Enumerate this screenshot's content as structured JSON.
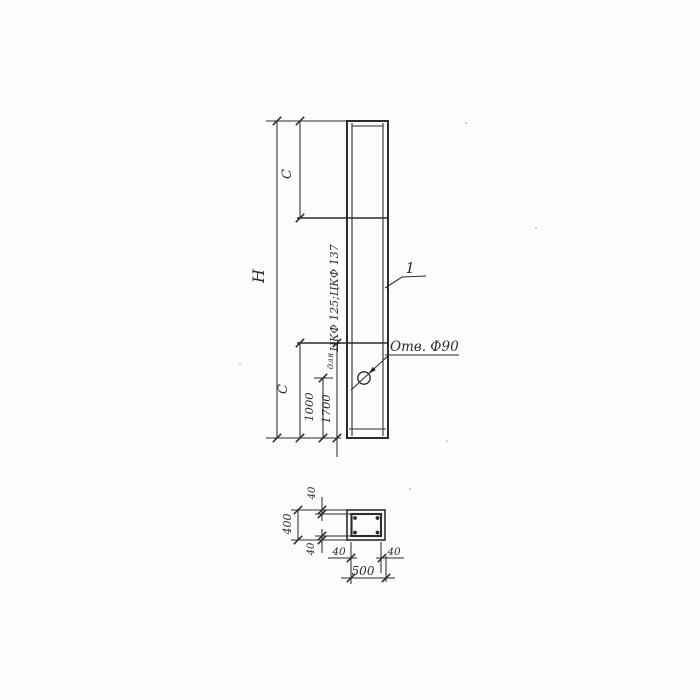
{
  "drawing": {
    "type": "engineering-drawing",
    "views": {
      "elevation": {
        "dim_total_height_label": "H",
        "dim_top_segment_label": "C",
        "dim_bottom_segment_label": "C",
        "dim_hole_from_bottom": "1000",
        "dim_line_from_bottom": "1700",
        "note_prefix": "для",
        "note_series": "ЦКФ 125;ЦКФ 137",
        "hole_callout": "Отв. Ф90",
        "item_mark": "1"
      },
      "section": {
        "dim_height_total": "400",
        "dim_width_total": "500",
        "cover_top": "40",
        "cover_bottom": "40",
        "cover_left": "40",
        "cover_right": "40"
      }
    },
    "colors": {
      "ink": "#2e2c29",
      "paper": "#fcfcfb"
    }
  }
}
